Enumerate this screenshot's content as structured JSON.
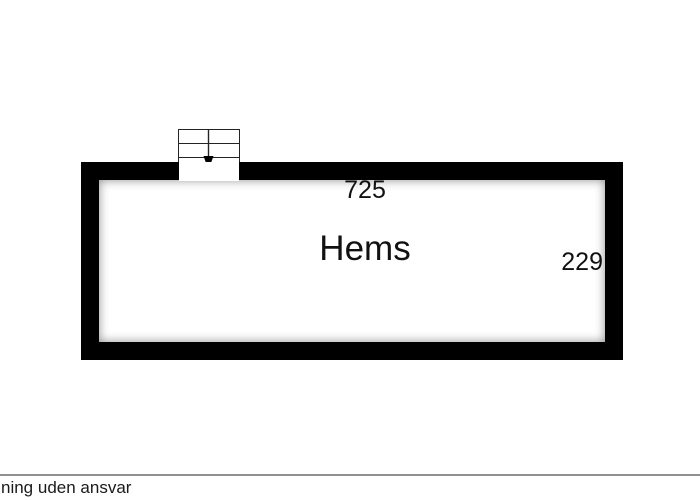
{
  "floorplan": {
    "room": {
      "label": "Hems"
    },
    "dimensions": {
      "width_label": "725",
      "height_label": "229"
    },
    "stairs": {
      "steps": 3,
      "direction": "down"
    },
    "colors": {
      "wall": "#000000",
      "background": "#ffffff",
      "stair_outline": "#242424",
      "footer_line": "#919191",
      "text": "#111111"
    }
  },
  "footer": {
    "disclaimer_text": "ning uden ansvar"
  }
}
